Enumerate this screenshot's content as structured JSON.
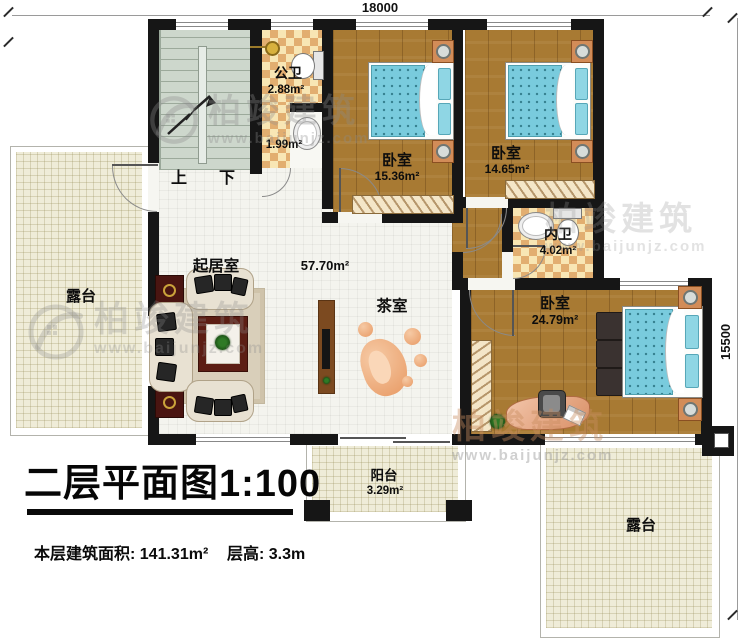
{
  "plan": {
    "dimensions": {
      "width_mm": "18000",
      "height_mm": "15500"
    },
    "stairs": {
      "up_label": "上",
      "down_label": "下"
    },
    "rooms": {
      "public_bath": {
        "name": "公卫",
        "area": "2.88m²"
      },
      "wash_area": {
        "area": "1.99m²"
      },
      "bedroom1": {
        "name": "卧室",
        "area": "15.36m²"
      },
      "bedroom2": {
        "name": "卧室",
        "area": "14.65m²"
      },
      "inner_bath": {
        "name": "内卫",
        "area": "4.02m²"
      },
      "master_bedroom": {
        "name": "卧室",
        "area": "24.79m²"
      },
      "living_room": {
        "name": "起居室",
        "area": "57.70m²"
      },
      "tea_room": {
        "name": "茶室"
      },
      "terrace_left": {
        "name": "露台"
      },
      "terrace_right": {
        "name": "露台"
      },
      "balcony": {
        "name": "阳台",
        "area": "3.29m²"
      }
    }
  },
  "title_block": {
    "title": "二层平面图1:100",
    "floor_area_text": "本层建筑面积: 141.31m²",
    "floor_height_text": "层高: 3.3m"
  },
  "watermark": {
    "brand": "柏竣建筑",
    "url": "www.baijunjz.com"
  },
  "colors": {
    "wall": "#161616",
    "wood_floor": "#a87a33",
    "checker_light": "#f8e6b4",
    "checker_dark": "#e2ae70",
    "living_tile": "#f4f4ee",
    "terrace": "#efecd8",
    "stairs": "#cdd7cc",
    "bed_blue": "#79cbdd",
    "nightstand_orange": "#d28c58"
  }
}
